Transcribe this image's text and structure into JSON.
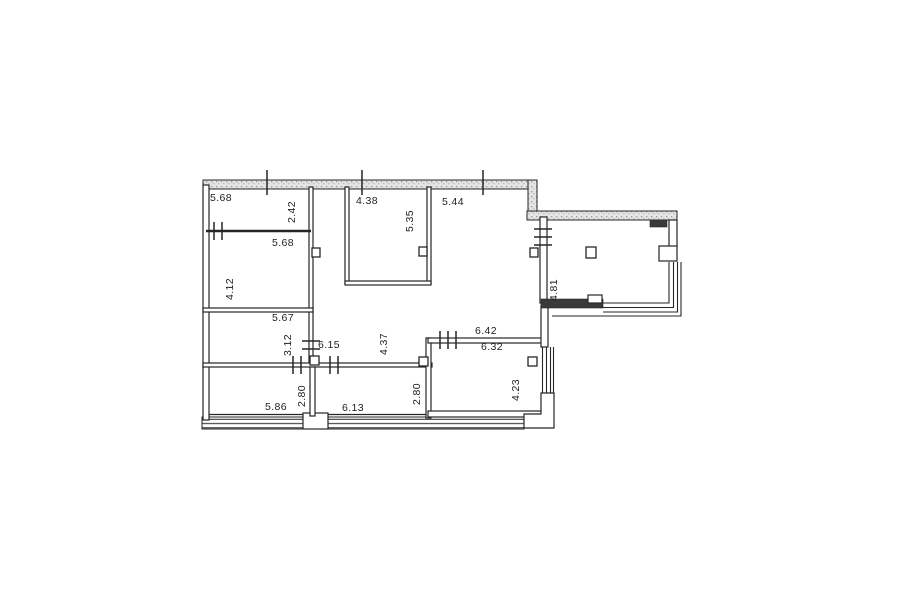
{
  "colors": {
    "line": "#262626",
    "bg": "#ffffff"
  },
  "labels": {
    "room_a_width": "5.68",
    "room_a_depth": "2.42",
    "room_b_width": "5.68",
    "room_b_depth": "4.12",
    "room_c_width": "5.67",
    "room_c_depth": "3.12",
    "hall_width": "6.15",
    "hall_depth": "4.37",
    "kitchen_width": "4.38",
    "kitchen_depth": "5.35",
    "living_width": "5.44",
    "dining_width_outer": "6.42",
    "dining_width_inner": "6.32",
    "dining_depth": "4.23",
    "terrace_depth": "4.81",
    "balcony1_width": "5.86",
    "balcony1_depth": "2.80",
    "balcony2_width": "6.13",
    "balcony2_depth": "2.80"
  }
}
